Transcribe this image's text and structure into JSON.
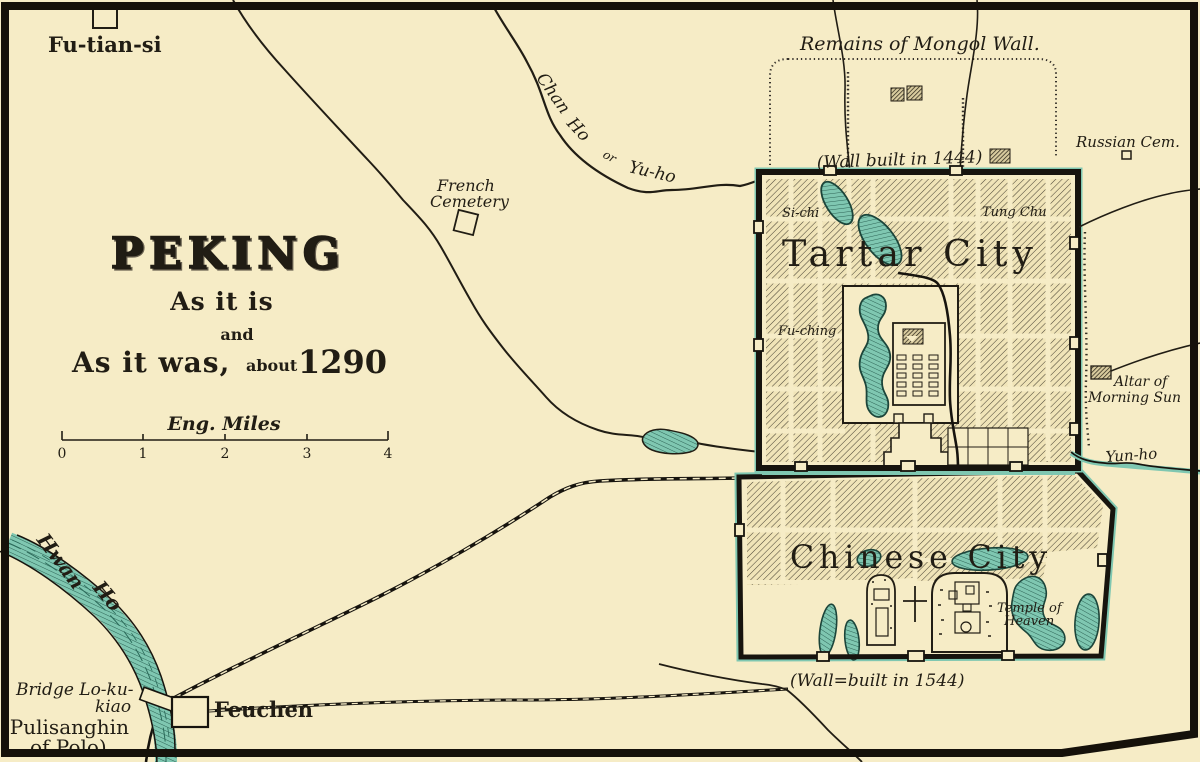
{
  "title": {
    "name": "PEKING",
    "sub1": "As it is",
    "sub2": "and",
    "sub3a": "As it was,",
    "sub3b": "about",
    "sub3c": "1290"
  },
  "scale": {
    "caption": "Eng. Miles",
    "ticks": [
      "0",
      "1",
      "2",
      "3",
      "4"
    ]
  },
  "colors": {
    "paper": "#f6ecc6",
    "ink": "#211d14",
    "water_fill": "#7fc7b1",
    "water_dark": "#23584a",
    "hatch_line": "#4a4435"
  },
  "labels": {
    "fu_tian_si": "Fu-tian-si",
    "mongol_wall": "Remains of Mongol Wall.",
    "wall_1444": "(Wall built in 1444)",
    "russian_cem": "Russian Cem.",
    "chan": "Chan",
    "ho": "Ho",
    "or": "or",
    "yu_ho": "Yu-ho",
    "french1": "French",
    "french2": "Cemetery",
    "si_chi": "Si-chi",
    "tung_chu": "Tung Chu",
    "fu_ching": "Fu-ching",
    "tartar_city": "Tartar City",
    "altar1": "Altar of",
    "altar2": "Morning Sun",
    "yun_ho": "Yun-ho",
    "chinese_city": "Chinese City",
    "temple1": "Temple of",
    "temple2": "Heaven",
    "wall_1544": "(Wall=built in 1544)",
    "hwan": "Hwan",
    "hwan2": "Ho",
    "bridge1": "Bridge Lo-ku-",
    "bridge2": "kiao",
    "polo1": "(Pulisanghin",
    "polo2": "of Polo)",
    "feuchen": "Feuchen"
  }
}
